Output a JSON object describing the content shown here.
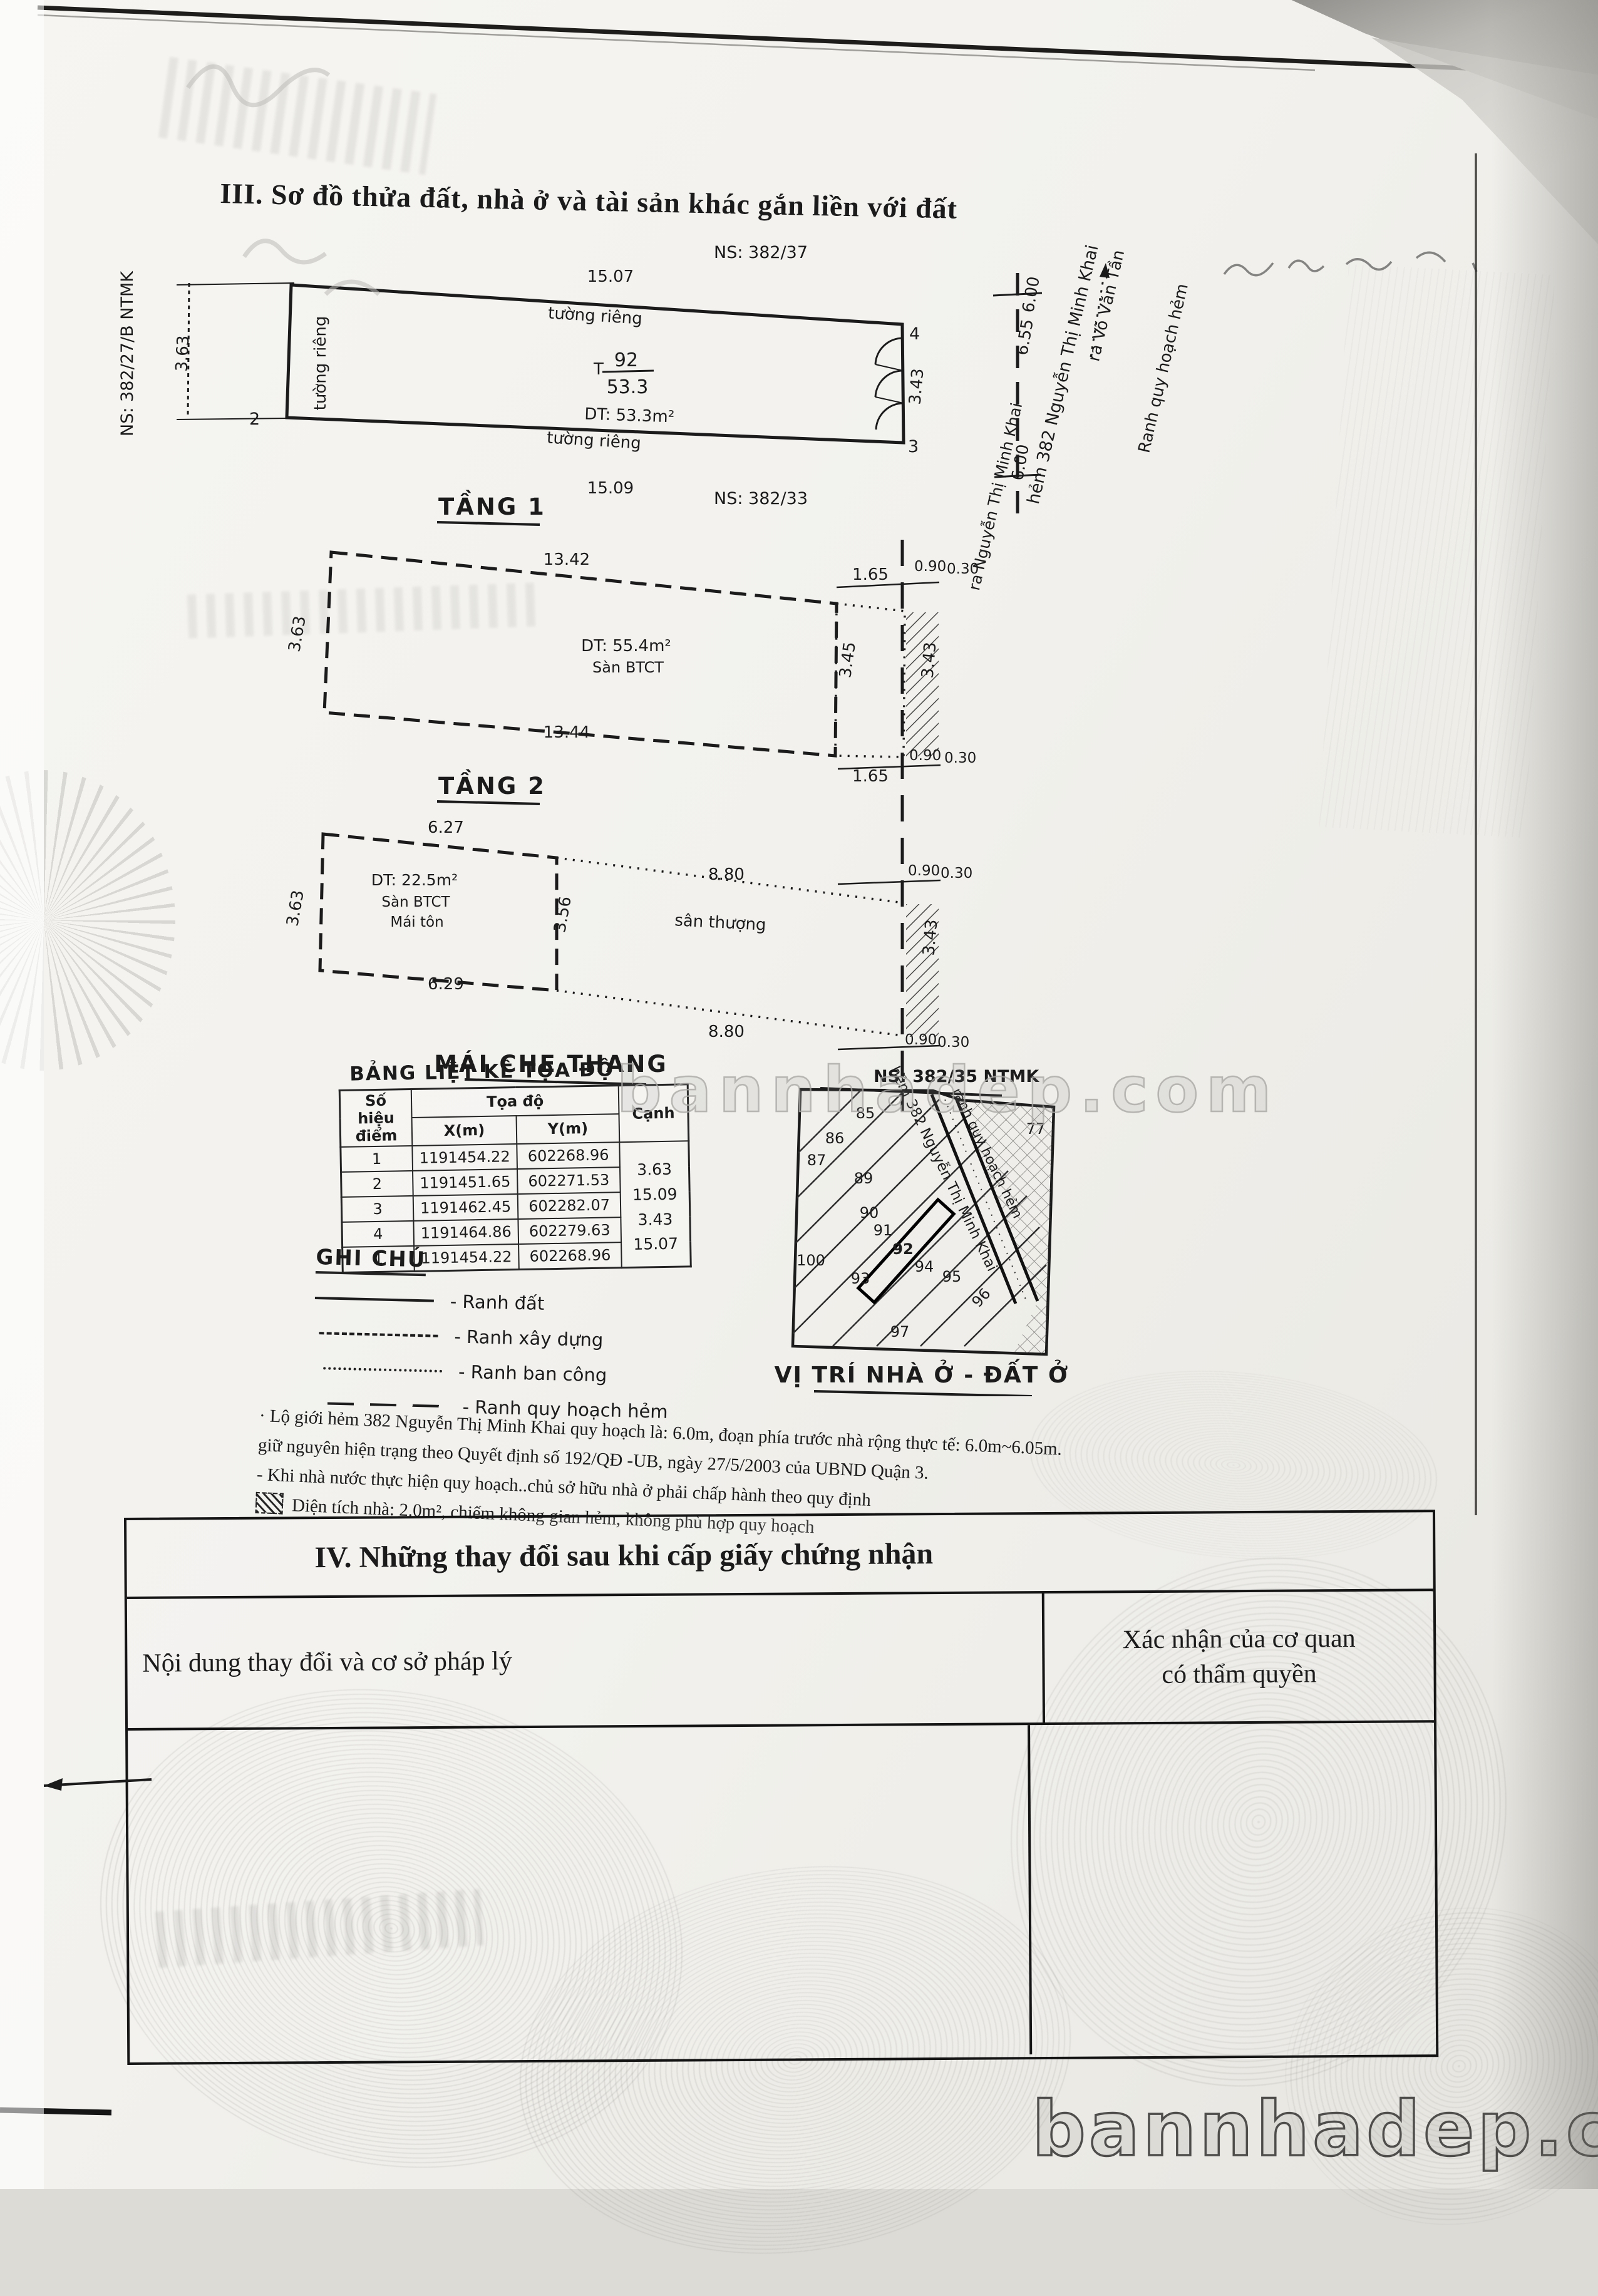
{
  "section3": {
    "title": "III. Sơ đồ thửa đất, nhà ở và tài sản khác gắn liền với đất"
  },
  "site_plan": {
    "ns_top": "NS: 382/37",
    "ns_left": "NS: 382/27/B NTMK",
    "ns_bottom": "NS: 382/33",
    "dim_top": "15.07",
    "dim_bottom": "15.09",
    "dim_left": "3.63",
    "dim_right": "3.43",
    "edge_top": "tường riêng",
    "edge_left": "tường riêng",
    "edge_bottom": "tường riêng",
    "parcel_prefix": "T",
    "parcel_number": "92",
    "parcel_area": "53.3",
    "area_text": "DT: 53.3m²",
    "point_2": "2",
    "point_3": "3",
    "point_4": "4",
    "alley_width_1": "6.00",
    "alley_width_2": "6.55",
    "alley_width_3": "6.00",
    "alley_name": "hẻm 382 Nguyễn Thị Minh Khai",
    "to_vo_van_tan": "ra Võ Văn Tần",
    "planning_boundary": "Ranh quy hoạch hẻm",
    "to_ntmk": "ra Nguyễn Thị Minh Khai"
  },
  "floor1": {
    "title": "TẦNG 1",
    "dim_top": "13.42",
    "dim_bottom": "13.44",
    "dim_left": "3.63",
    "dim_mid": "3.45",
    "dim_right": "3.43",
    "dim_a": "1.65",
    "dim_b": "0.90",
    "dim_c": "0.30",
    "area_text": "DT: 55.4m²",
    "slab_text": "Sàn BTCT"
  },
  "floor2": {
    "title": "TẦNG 2",
    "dim_top_left": "6.27",
    "dim_top_right": "8.80",
    "dim_bottom_left": "6.29",
    "dim_bottom_right": "8.80",
    "dim_left": "3.63",
    "dim_mid": "3.56",
    "dim_right": "3.43",
    "dim_b": "0.90",
    "dim_c": "0.30",
    "area_text": "DT: 22.5m²",
    "slab_text": "Sàn BTCT",
    "roof_text": "Mái tôn",
    "terrace_text": "sân thượng",
    "footer": "MÁI CHE THANG"
  },
  "coord_table": {
    "title": "BẢNG LIỆT KÊ TỌA ĐỘ",
    "col_point": "Số hiệu điểm",
    "col_group": "Tọa độ",
    "col_x": "X(m)",
    "col_y": "Y(m)",
    "col_edge": "Cạnh",
    "rows": [
      {
        "p": "1",
        "x": "1191454.22",
        "y": "602268.96",
        "c": ""
      },
      {
        "p": "2",
        "x": "1191451.65",
        "y": "602271.53",
        "c": "3.63"
      },
      {
        "p": "3",
        "x": "1191462.45",
        "y": "602282.07",
        "c": "15.09"
      },
      {
        "p": "4",
        "x": "1191464.86",
        "y": "602279.63",
        "c": "3.43"
      },
      {
        "p": "1",
        "x": "1191454.22",
        "y": "602268.96",
        "c": "15.07"
      }
    ]
  },
  "legend": {
    "title": "GHI CHÚ",
    "items": [
      {
        "label": "- Ranh đất"
      },
      {
        "label": "- Ranh xây dựng"
      },
      {
        "label": "- Ranh ban công"
      },
      {
        "label": "- Ranh quy hoạch hẻm"
      }
    ]
  },
  "notes": {
    "line1": "· Lộ giới hẻm 382 Nguyễn Thị Minh Khai quy hoạch là: 6.0m, đoạn phía trước nhà rộng thực tế: 6.0m~6.05m.",
    "line2": "giữ nguyên hiện trạng  theo Quyết định số 192/QĐ -UB, ngày 27/5/2003 của UBND Quận 3.",
    "line3": "- Khi nhà nước thực hiện quy hoạch..chủ sở hữu nhà ở phải chấp hành theo quy định",
    "line4": "Diện tích nhà: 2.0m², chiếm không gian hẻm, không phù hợp quy hoạch"
  },
  "location_map": {
    "header": "NS: 382/35 NTMK",
    "caption": "VỊ TRÍ NHÀ Ở - ĐẤT Ở",
    "street": "hẻm 382 Nguyễn Thị Minh Khai",
    "planning": "ranh quy hoạch hẻm",
    "parcels": {
      "p85": "85",
      "p86": "86",
      "p87": "87",
      "p89": "89",
      "p90": "90",
      "p91": "91",
      "p92": "92",
      "p93": "93",
      "p94": "94",
      "p95": "95",
      "p96": "96",
      "p97": "97",
      "p100": "100",
      "p77": "77"
    }
  },
  "section4": {
    "title": "IV. Những thay đổi sau khi cấp giấy chứng nhận",
    "col_left": "Nội dung thay đổi và cơ sở pháp lý",
    "col_right_line1": "Xác nhận của cơ quan",
    "col_right_line2": "có thẩm quyền"
  },
  "watermark": {
    "text": "bannhadep.com"
  }
}
